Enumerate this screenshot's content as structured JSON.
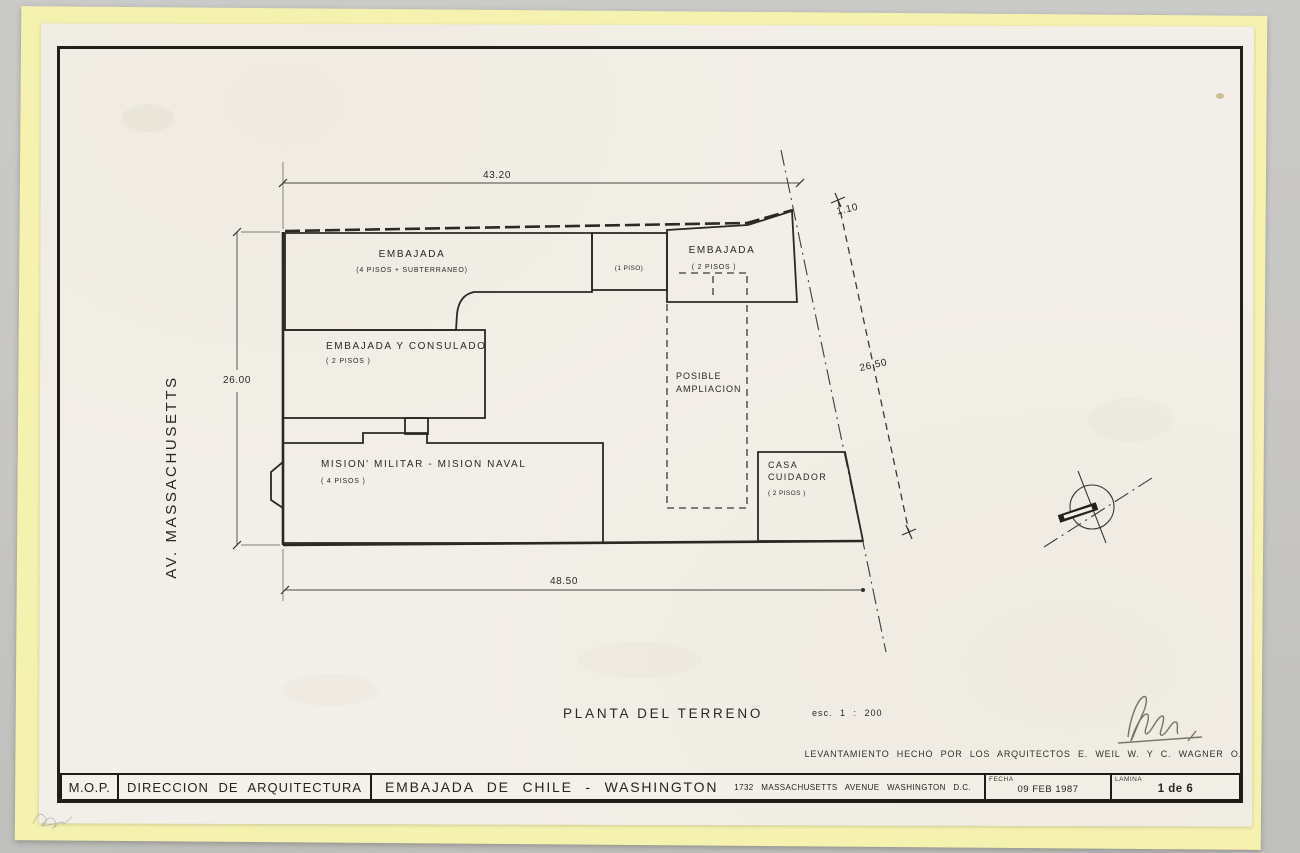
{
  "colors": {
    "background": "#c7c6c3",
    "backing_paper": "#f5f1af",
    "sheet": "#f2efe8",
    "ink": "#26241e"
  },
  "street": {
    "label": "AV. MASSACHUSETTS"
  },
  "plan_title": {
    "text": "PLANTA DEL TERRENO",
    "scale": "esc. 1 : 200"
  },
  "dimensions": {
    "top": "43.20",
    "left": "26.00",
    "bottom": "48.50",
    "right_length": "26.50",
    "right_offset": "1.10"
  },
  "buildings": {
    "embajada_main": {
      "name": "EMBAJADA",
      "floors": "(4 PISOS + SUBTERRANEO)"
    },
    "embajada_link": {
      "floors": "(1 PISO)"
    },
    "embajada_annex": {
      "name": "EMBAJADA",
      "floors": "( 2 PISOS )"
    },
    "consulado": {
      "name": "EMBAJADA Y CONSULADO",
      "floors": "( 2 PISOS )"
    },
    "mision": {
      "name": "MISION' MILITAR - MISION NAVAL",
      "floors": "( 4 PISOS )"
    },
    "ampliacion": {
      "line1": "POSIBLE",
      "line2": "AMPLIACION"
    },
    "casa_cuidador": {
      "line1": "CASA",
      "line2": "CUIDADOR",
      "floors": "( 2 PISOS )"
    }
  },
  "credits": "LEVANTAMIENTO HECHO POR LOS ARQUITECTOS E. WEIL W. Y C. WAGNER O.",
  "title_block": {
    "org": "M.O.P.",
    "department": "DIRECCION DE ARQUITECTURA",
    "project": "EMBAJADA DE CHILE - WASHINGTON",
    "address": "1732 MASSACHUSETTS AVENUE WASHINGTON D.C.",
    "date_label": "FECHA",
    "date_value": "09 FEB 1987",
    "sheet_label": "LAMINA",
    "sheet_value": "1 de 6"
  }
}
